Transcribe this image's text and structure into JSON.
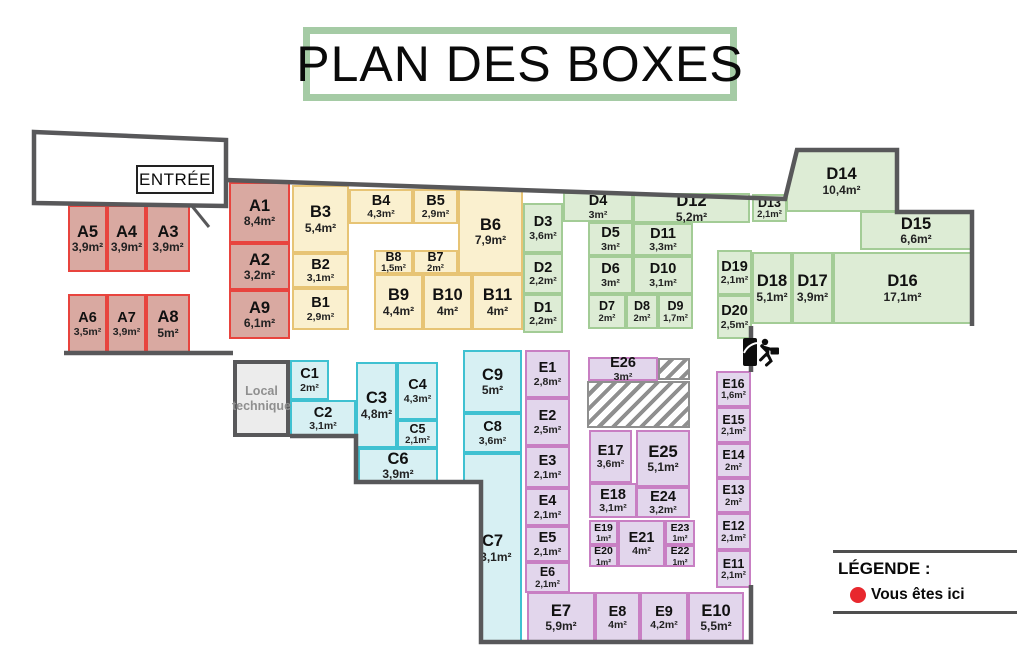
{
  "title": "PLAN DES BOXES",
  "entrance": {
    "label": "ENTRÉE"
  },
  "local_technique": {
    "line1": "Local",
    "line2": "technique"
  },
  "legend": {
    "title": "LÉGENDE :",
    "items": [
      {
        "marker": "red-dot",
        "color": "#e8282e",
        "label": "Vous êtes ici"
      }
    ]
  },
  "colors": {
    "wall": "#58585a",
    "title_border": "#a5cba5",
    "hatch_gray": "#8f8f8f"
  },
  "zones": {
    "A": {
      "fill": "#d9a9a1",
      "border": "#e8443e"
    },
    "B": {
      "fill": "#faf0cf",
      "border": "#e7c475"
    },
    "C": {
      "fill": "#d7f0f3",
      "border": "#3fc1d1"
    },
    "D": {
      "fill": "#ddecd5",
      "border": "#a3cc96"
    },
    "E": {
      "fill": "#e2d6ec",
      "border": "#c87fc3"
    }
  },
  "boxes": [
    {
      "id": "A1",
      "area": "8,4m²",
      "zone": "A",
      "x": 229,
      "y": 182,
      "w": 61,
      "h": 61
    },
    {
      "id": "A2",
      "area": "3,2m²",
      "zone": "A",
      "x": 229,
      "y": 243,
      "w": 61,
      "h": 47
    },
    {
      "id": "A3",
      "area": "3,9m²",
      "zone": "A",
      "x": 146,
      "y": 205,
      "w": 44,
      "h": 67
    },
    {
      "id": "A4",
      "area": "3,9m²",
      "zone": "A",
      "x": 107,
      "y": 205,
      "w": 39,
      "h": 67
    },
    {
      "id": "A5",
      "area": "3,9m²",
      "zone": "A",
      "x": 68,
      "y": 205,
      "w": 39,
      "h": 67
    },
    {
      "id": "A6",
      "area": "3,5m²",
      "zone": "A",
      "x": 68,
      "y": 294,
      "w": 39,
      "h": 60
    },
    {
      "id": "A7",
      "area": "3,9m²",
      "zone": "A",
      "x": 107,
      "y": 294,
      "w": 39,
      "h": 60
    },
    {
      "id": "A8",
      "area": "5m²",
      "zone": "A",
      "x": 146,
      "y": 294,
      "w": 44,
      "h": 60
    },
    {
      "id": "A9",
      "area": "6,1m²",
      "zone": "A",
      "x": 229,
      "y": 290,
      "w": 61,
      "h": 49
    },
    {
      "id": "B1",
      "area": "2,9m²",
      "zone": "B",
      "x": 292,
      "y": 288,
      "w": 57,
      "h": 42
    },
    {
      "id": "B2",
      "area": "3,1m²",
      "zone": "B",
      "x": 292,
      "y": 253,
      "w": 57,
      "h": 35
    },
    {
      "id": "B3",
      "area": "5,4m²",
      "zone": "B",
      "x": 292,
      "y": 185,
      "w": 57,
      "h": 68
    },
    {
      "id": "B4",
      "area": "4,3m²",
      "zone": "B",
      "x": 349,
      "y": 189,
      "w": 64,
      "h": 35
    },
    {
      "id": "B5",
      "area": "2,9m²",
      "zone": "B",
      "x": 413,
      "y": 189,
      "w": 45,
      "h": 35
    },
    {
      "id": "B6",
      "area": "7,9m²",
      "zone": "B",
      "x": 458,
      "y": 189,
      "w": 65,
      "h": 85
    },
    {
      "id": "B7",
      "area": "2m²",
      "zone": "B",
      "x": 413,
      "y": 250,
      "w": 45,
      "h": 24
    },
    {
      "id": "B8",
      "area": "1,5m²",
      "zone": "B",
      "x": 374,
      "y": 250,
      "w": 39,
      "h": 24
    },
    {
      "id": "B9",
      "area": "4,4m²",
      "zone": "B",
      "x": 374,
      "y": 274,
      "w": 49,
      "h": 56
    },
    {
      "id": "B10",
      "area": "4m²",
      "zone": "B",
      "x": 423,
      "y": 274,
      "w": 49,
      "h": 56
    },
    {
      "id": "B11",
      "area": "4m²",
      "zone": "B",
      "x": 472,
      "y": 274,
      "w": 51,
      "h": 56
    },
    {
      "id": "C1",
      "area": "2m²",
      "zone": "C",
      "x": 290,
      "y": 360,
      "w": 39,
      "h": 40
    },
    {
      "id": "C2",
      "area": "3,1m²",
      "zone": "C",
      "x": 290,
      "y": 400,
      "w": 66,
      "h": 37
    },
    {
      "id": "C3",
      "area": "4,8m²",
      "zone": "C",
      "x": 356,
      "y": 362,
      "w": 41,
      "h": 86
    },
    {
      "id": "C4",
      "area": "4,3m²",
      "zone": "C",
      "x": 397,
      "y": 362,
      "w": 41,
      "h": 58
    },
    {
      "id": "C5",
      "area": "2,1m²",
      "zone": "C",
      "x": 397,
      "y": 420,
      "w": 41,
      "h": 28
    },
    {
      "id": "C6",
      "area": "3,9m²",
      "zone": "C",
      "x": 358,
      "y": 448,
      "w": 80,
      "h": 35
    },
    {
      "id": "C7",
      "area": "13,1m²",
      "zone": "C",
      "x": 463,
      "y": 453,
      "w": 59,
      "h": 190
    },
    {
      "id": "C8",
      "area": "3,6m²",
      "zone": "C",
      "x": 463,
      "y": 413,
      "w": 59,
      "h": 40
    },
    {
      "id": "C9",
      "area": "5m²",
      "zone": "C",
      "x": 463,
      "y": 350,
      "w": 59,
      "h": 63
    },
    {
      "id": "D1",
      "area": "2,2m²",
      "zone": "D",
      "x": 523,
      "y": 294,
      "w": 40,
      "h": 39
    },
    {
      "id": "D2",
      "area": "2,2m²",
      "zone": "D",
      "x": 523,
      "y": 253,
      "w": 40,
      "h": 41
    },
    {
      "id": "D3",
      "area": "3,6m²",
      "zone": "D",
      "x": 523,
      "y": 203,
      "w": 40,
      "h": 50
    },
    {
      "id": "D4",
      "area": "3m²",
      "zone": "D",
      "x": 563,
      "y": 192,
      "w": 70,
      "h": 30
    },
    {
      "id": "D5",
      "area": "3m²",
      "zone": "D",
      "x": 588,
      "y": 222,
      "w": 45,
      "h": 34
    },
    {
      "id": "D6",
      "area": "3m²",
      "zone": "D",
      "x": 588,
      "y": 256,
      "w": 45,
      "h": 38
    },
    {
      "id": "D7",
      "area": "2m²",
      "zone": "D",
      "x": 588,
      "y": 294,
      "w": 38,
      "h": 35
    },
    {
      "id": "D8",
      "area": "2m²",
      "zone": "D",
      "x": 626,
      "y": 294,
      "w": 32,
      "h": 35
    },
    {
      "id": "D9",
      "area": "1,7m²",
      "zone": "D",
      "x": 658,
      "y": 294,
      "w": 35,
      "h": 35
    },
    {
      "id": "D10",
      "area": "3,1m²",
      "zone": "D",
      "x": 633,
      "y": 256,
      "w": 60,
      "h": 38
    },
    {
      "id": "D11",
      "area": "3,3m²",
      "zone": "D",
      "x": 633,
      "y": 223,
      "w": 60,
      "h": 33
    },
    {
      "id": "D12",
      "area": "5,2m²",
      "zone": "D",
      "x": 633,
      "y": 193,
      "w": 117,
      "h": 30
    },
    {
      "id": "D13",
      "area": "2,1m²",
      "zone": "D",
      "x": 752,
      "y": 194,
      "w": 35,
      "h": 28
    },
    {
      "id": "D14",
      "area": "10,4m²",
      "zone": "D",
      "x": 786,
      "y": 150,
      "w": 111,
      "h": 62
    },
    {
      "id": "D15",
      "area": "6,6m²",
      "zone": "D",
      "x": 860,
      "y": 211,
      "w": 112,
      "h": 39
    },
    {
      "id": "D16",
      "area": "17,1m²",
      "zone": "D",
      "x": 833,
      "y": 252,
      "w": 139,
      "h": 72
    },
    {
      "id": "D17",
      "area": "3,9m²",
      "zone": "D",
      "x": 792,
      "y": 252,
      "w": 41,
      "h": 72
    },
    {
      "id": "D18",
      "area": "5,1m²",
      "zone": "D",
      "x": 752,
      "y": 252,
      "w": 40,
      "h": 72
    },
    {
      "id": "D19",
      "area": "2,1m²",
      "zone": "D",
      "x": 717,
      "y": 250,
      "w": 35,
      "h": 45
    },
    {
      "id": "D20",
      "area": "2,5m²",
      "zone": "D",
      "x": 717,
      "y": 295,
      "w": 35,
      "h": 44
    },
    {
      "id": "E1",
      "area": "2,8m²",
      "zone": "E",
      "x": 525,
      "y": 350,
      "w": 45,
      "h": 48
    },
    {
      "id": "E2",
      "area": "2,5m²",
      "zone": "E",
      "x": 525,
      "y": 398,
      "w": 45,
      "h": 48
    },
    {
      "id": "E3",
      "area": "2,1m²",
      "zone": "E",
      "x": 525,
      "y": 446,
      "w": 45,
      "h": 42
    },
    {
      "id": "E4",
      "area": "2,1m²",
      "zone": "E",
      "x": 525,
      "y": 488,
      "w": 45,
      "h": 38
    },
    {
      "id": "E5",
      "area": "2,1m²",
      "zone": "E",
      "x": 525,
      "y": 526,
      "w": 45,
      "h": 36
    },
    {
      "id": "E6",
      "area": "2,1m²",
      "zone": "E",
      "x": 525,
      "y": 562,
      "w": 45,
      "h": 31
    },
    {
      "id": "E7",
      "area": "5,9m²",
      "zone": "E",
      "x": 527,
      "y": 592,
      "w": 68,
      "h": 51
    },
    {
      "id": "E8",
      "area": "4m²",
      "zone": "E",
      "x": 595,
      "y": 592,
      "w": 45,
      "h": 51
    },
    {
      "id": "E9",
      "area": "4,2m²",
      "zone": "E",
      "x": 640,
      "y": 592,
      "w": 48,
      "h": 51
    },
    {
      "id": "E10",
      "area": "5,5m²",
      "zone": "E",
      "x": 688,
      "y": 592,
      "w": 56,
      "h": 51
    },
    {
      "id": "E11",
      "area": "2,1m²",
      "zone": "E",
      "x": 716,
      "y": 550,
      "w": 35,
      "h": 38
    },
    {
      "id": "E12",
      "area": "2,1m²",
      "zone": "E",
      "x": 716,
      "y": 513,
      "w": 35,
      "h": 37
    },
    {
      "id": "E13",
      "area": "2m²",
      "zone": "E",
      "x": 716,
      "y": 478,
      "w": 35,
      "h": 35
    },
    {
      "id": "E14",
      "area": "2m²",
      "zone": "E",
      "x": 716,
      "y": 443,
      "w": 35,
      "h": 35
    },
    {
      "id": "E15",
      "area": "2,1m²",
      "zone": "E",
      "x": 716,
      "y": 407,
      "w": 35,
      "h": 36
    },
    {
      "id": "E16",
      "area": "1,6m²",
      "zone": "E",
      "x": 716,
      "y": 371,
      "w": 35,
      "h": 36
    },
    {
      "id": "E17",
      "area": "3,6m²",
      "zone": "E",
      "x": 589,
      "y": 430,
      "w": 43,
      "h": 53
    },
    {
      "id": "E18",
      "area": "3,1m²",
      "zone": "E",
      "x": 589,
      "y": 483,
      "w": 48,
      "h": 35
    },
    {
      "id": "E19",
      "area": "1m²",
      "zone": "E",
      "x": 589,
      "y": 520,
      "w": 29,
      "h": 25
    },
    {
      "id": "E20",
      "area": "1m²",
      "zone": "E",
      "x": 589,
      "y": 545,
      "w": 29,
      "h": 22
    },
    {
      "id": "E21",
      "area": "4m²",
      "zone": "E",
      "x": 618,
      "y": 520,
      "w": 47,
      "h": 47
    },
    {
      "id": "E22",
      "area": "1m²",
      "zone": "E",
      "x": 665,
      "y": 545,
      "w": 30,
      "h": 22
    },
    {
      "id": "E23",
      "area": "1m²",
      "zone": "E",
      "x": 665,
      "y": 520,
      "w": 30,
      "h": 25
    },
    {
      "id": "E24",
      "area": "3,2m²",
      "zone": "E",
      "x": 636,
      "y": 487,
      "w": 54,
      "h": 31
    },
    {
      "id": "E25",
      "area": "5,1m²",
      "zone": "E",
      "x": 636,
      "y": 430,
      "w": 54,
      "h": 57
    },
    {
      "id": "E26",
      "area": "3m²",
      "zone": "E",
      "x": 588,
      "y": 357,
      "w": 70,
      "h": 24
    }
  ],
  "hatched_areas": [
    {
      "x": 658,
      "y": 358,
      "w": 32,
      "h": 22
    },
    {
      "x": 587,
      "y": 381,
      "w": 103,
      "h": 47
    }
  ]
}
